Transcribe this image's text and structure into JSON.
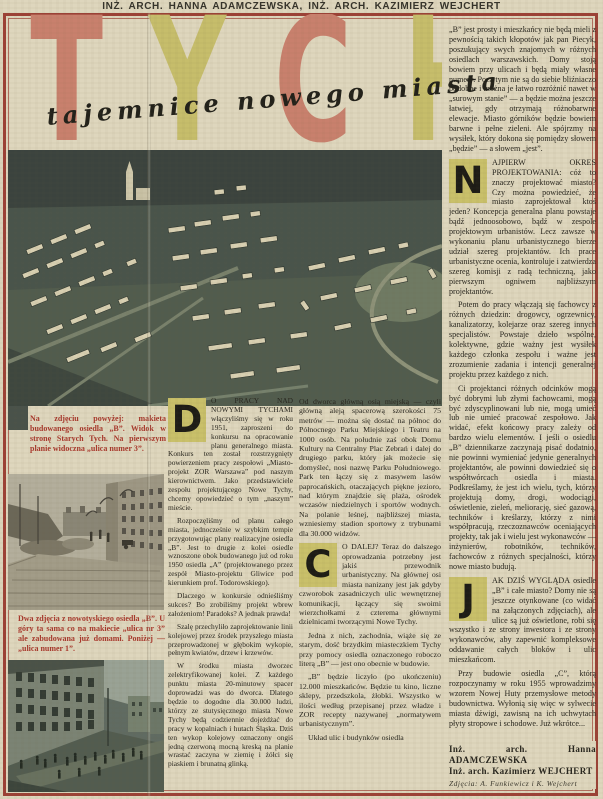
{
  "header": {
    "authors_line": "INŻ. ARCH. HANNA ADAMCZEWSKA, INŻ. ARCH. KAZIMIERZ WEJCHERT"
  },
  "title": {
    "word": "TYCHY",
    "letters": [
      "T",
      "Y",
      "C",
      "H",
      "Y"
    ],
    "subtitle": "tajemnice nowego miasta"
  },
  "captions": {
    "model": "Na zdjęciu powyżej: makieta budowanego osiedla „B”. Widok w stronę Starych Tych. Na pierwszym planie widoczna „ulica numer 3”.",
    "streets": "Dwa zdjęcia z nowotyskiego osiedla „B”. U góry ta sama co na makiecie „ulica nr 3” ale zabudowana już domami. Poniżej — „ulica numer 1”."
  },
  "columns": {
    "left": {
      "dropcap": "D",
      "lead": "O PRACY NAD NOWYMI TYCHAMI włączyliśmy się w roku 1951, zaproszeni do konkursu na opracowanie planu generalnego miasta. Konkurs ten został rozstrzygnięty powierzeniem pracy zespołowi „Miasto-projekt ZOR Warszawa” pod naszym kierownictwem. Jako przedstawiciele zespołu projektującego Nowe Tychy, chcemy opowiedzieć o tym „naszym” mieście.",
      "paras": [
        "Rozpoczęliśmy od planu całego miasta, jednocześnie w szybkim tempie przygotowując plany realizacyjne osiedla „B”. Jest to drugie z kolei osiedle wznoszone obok budowanego już od roku 1950 osiedla „A” (projektowanego przez zespół Miasto-projektu Gliwice pod kierunkiem prof. Todorowskiego).",
        "Dlaczego w konkursie odnieśliśmy sukces? Bo zrobiliśmy projekt wbrew założeniom! Paradoks? A jednak prawda!",
        "Szalę przechyliło zaprojektowanie linii kolejowej przez środek przyszłego miasta przeprowadzonej w głębokim wykopie, pełnym kwiatów, drzew i krzewów.",
        "W środku miasta dworzec zelektryfikowanej kolei. Z każdego punktu miasta 20-minutowy spacer doprowadzi was do dworca. Dlatego będzie to dogodne dla 30.000 ludzi, którzy ze stutysięcznego miasta Nowe Tychy będą codziennie dojeżdżać do pracy w kopalniach i hutach Śląska. Dziś ten wykop kolejowy oznaczony ongiś jedną czerwoną mocną kreską na planie wrastać zaczyna w ziemię i żółci się piaskiem i brunatną glinką."
      ]
    },
    "middle": {
      "p_top": "Od dworca główną osią miejską — czyli główną aleją spacerową szerokości 75 metrów — można się dostać na północ do Północnego Parku Miejskiego i Teatru na 1000 osób. Na południe zaś obok Domu Kultury na Centralny Plac Zebrań i dalej do drugiego parku, który jak możecie się domyśleć, nosi nazwę Parku Południowego. Park ten łączy się z masywem lasów paprocańskich, otaczających piękne jezioro, nad którym znajdzie się plaża, ośrodek wczasów niedzielnych i sportów wodnych. Na polanie leśnej, najbliższej miasta, wzniesiemy stadion sportowy z trybunami dla 30.000 widzów.",
      "dropcap": "C",
      "lead": "O DALEJ? Teraz do dalszego oprowadzania potrzebny jest jakiś przewodnik urbanistyczny. Na głównej osi miasta nanizany jest jak gdyby czworobok zasadniczych ulic wewnętrznej komunikacji, łączący się swoimi wierzchołkami z czterema głównymi dzielnicami tworzącymi Nowe Tychy.",
      "paras": [
        "Jedna z nich, zachodnia, wiąże się ze starym, dość brzydkim miasteczkiem Tychy przy pomocy osiedla oznaczonego roboczo literą „B” — jest ono obecnie w budowie.",
        "„B” będzie liczyło (po ukończeniu) 12.000 mieszkańców. Będzie tu kino, liczne sklepy, przedszkola, żłobki. Wszystko w ilości według przepisanej przez władze i ZOR recepty nazywanej „normatywem urbanistycznym”.",
        "Układ ulic i budynków osiedla"
      ]
    },
    "right": {
      "p_intro": "„B” jest prosty i mieszkańcy nie będą mieli z pewnością takich kłopotów jak pan Piecyk, poszukujący swych znajomych w różnych osiedlach warszawskich. Domy stoją bowiem przy ulicach i będą miały własne numery. Poza tym nie są do siebie bliźniaczo podobne i można je łatwo rozróżnić nawet w „surowym stanie” — a będzie można jeszcze łatwiej, gdy otrzymają różnobarwne elewacje. Miasto górników będzie bowiem barwne i pełne zieleni. Ale spójrzmy na wysiłek, który dokona się pomiędzy słowem „będzie” — a słowem „jest”.",
      "n_dropcap": "N",
      "n_text": "AJPIERW OKRES PROJEKTOWANIA: cóż to znaczy projektować miasto? Czy można powiedzieć, że miasto zaprojektował ktoś jeden? Koncepcja generalna planu powstaje bądź jednoosobowo, bądź w zespole projektowym urbanistów. Lecz zawsze w wykonaniu planu urbanistycznego bierze udział szereg projektantów. Ich prace urbanistyczne ocenia, kontroluje i zatwierdza szereg komisji z radą techniczną, jako pierwszym ogniwem najbliższym projektantów.",
      "p_potem": "Potem do pracy włączają się fachowcy z różnych dziedzin: drogowcy, ogrzewnicy, kanalizatorzy, kolejarze oraz szereg innych specjalistów. Powstaje dzieło wspólne, kolektywne, gdzie ważny jest wysiłek każdego członka zespołu i ważne jest zrozumienie zadania i intencji generalnej projektu przez każdego z nich.",
      "p_ci": "Ci projektanci różnych odcinków mogą być dobrymi lub złymi fachowcami, mogą być zdyscyplinowani lub nie, mogą umieć lub nie umieć pracować zespołowo. Jak widać, efekt końcowy pracy zależy od bardzo wielu elementów. I jeśli o osiedlu „B” dziennikarze zaczynają pisać dodatnio, nie powinni wymieniać jedynie generalnych projektantów, ale powinni dowiedzieć się o współtwórcach osiedla i miasta. Podkreślamy, że jest ich wielu, tych, którzy projektują domy, drogi, wodociągi, oświetlenie, zieleń, meliorację, sieć gazową, techników i kreślarzy, którzy z nimi współpracują, rzeczoznawców oceniających projekty, tak jak i wielu jest wykonawców — inżynierów, robotników, techników, fachowców z różnych specjalności, którzy nowe miasto budują.",
      "j_dropcap": "J",
      "j_text": "AK DZIŚ WYGLĄDA osiedle „B” i całe miasto? Domy nie są jeszcze otynkowane (co widać na załączonych zdjęciach), ale ulice są już oświetlone, robi się wszystko i ze strony inwestora i ze strony wykonawców, aby zapewnić kompleksowe oddawanie całych bloków i ulic mieszkańcom.",
      "p_przy": "Przy budowie osiedla „C”, którą rozpoczynamy w roku 1955 wprowadzimy wzorem Nowej Huty przemysłowe metody budownictwa. Wyłonią się więc w sylwecie miasta dźwigi, zawisną na ich uchwytach płyty stropowe i schodowe. Już wkrótce..."
    }
  },
  "signature": {
    "line1": "Inż. arch. Hanna ADAMCZEWSKA",
    "line2": "Inż. arch. Kazimierz WEJCHERT",
    "credit": "Zdjęcia: A. Funkiewicz i K. Wejchert"
  },
  "colors": {
    "page_bg": "#ded6bd",
    "frame_red": "#9c4136",
    "title_salmon": "#c8806d",
    "title_olive": "#c6bd6b",
    "caption_red": "#a8382c",
    "dropcap_bg": "#c9c06a",
    "ink": "#27251e"
  }
}
